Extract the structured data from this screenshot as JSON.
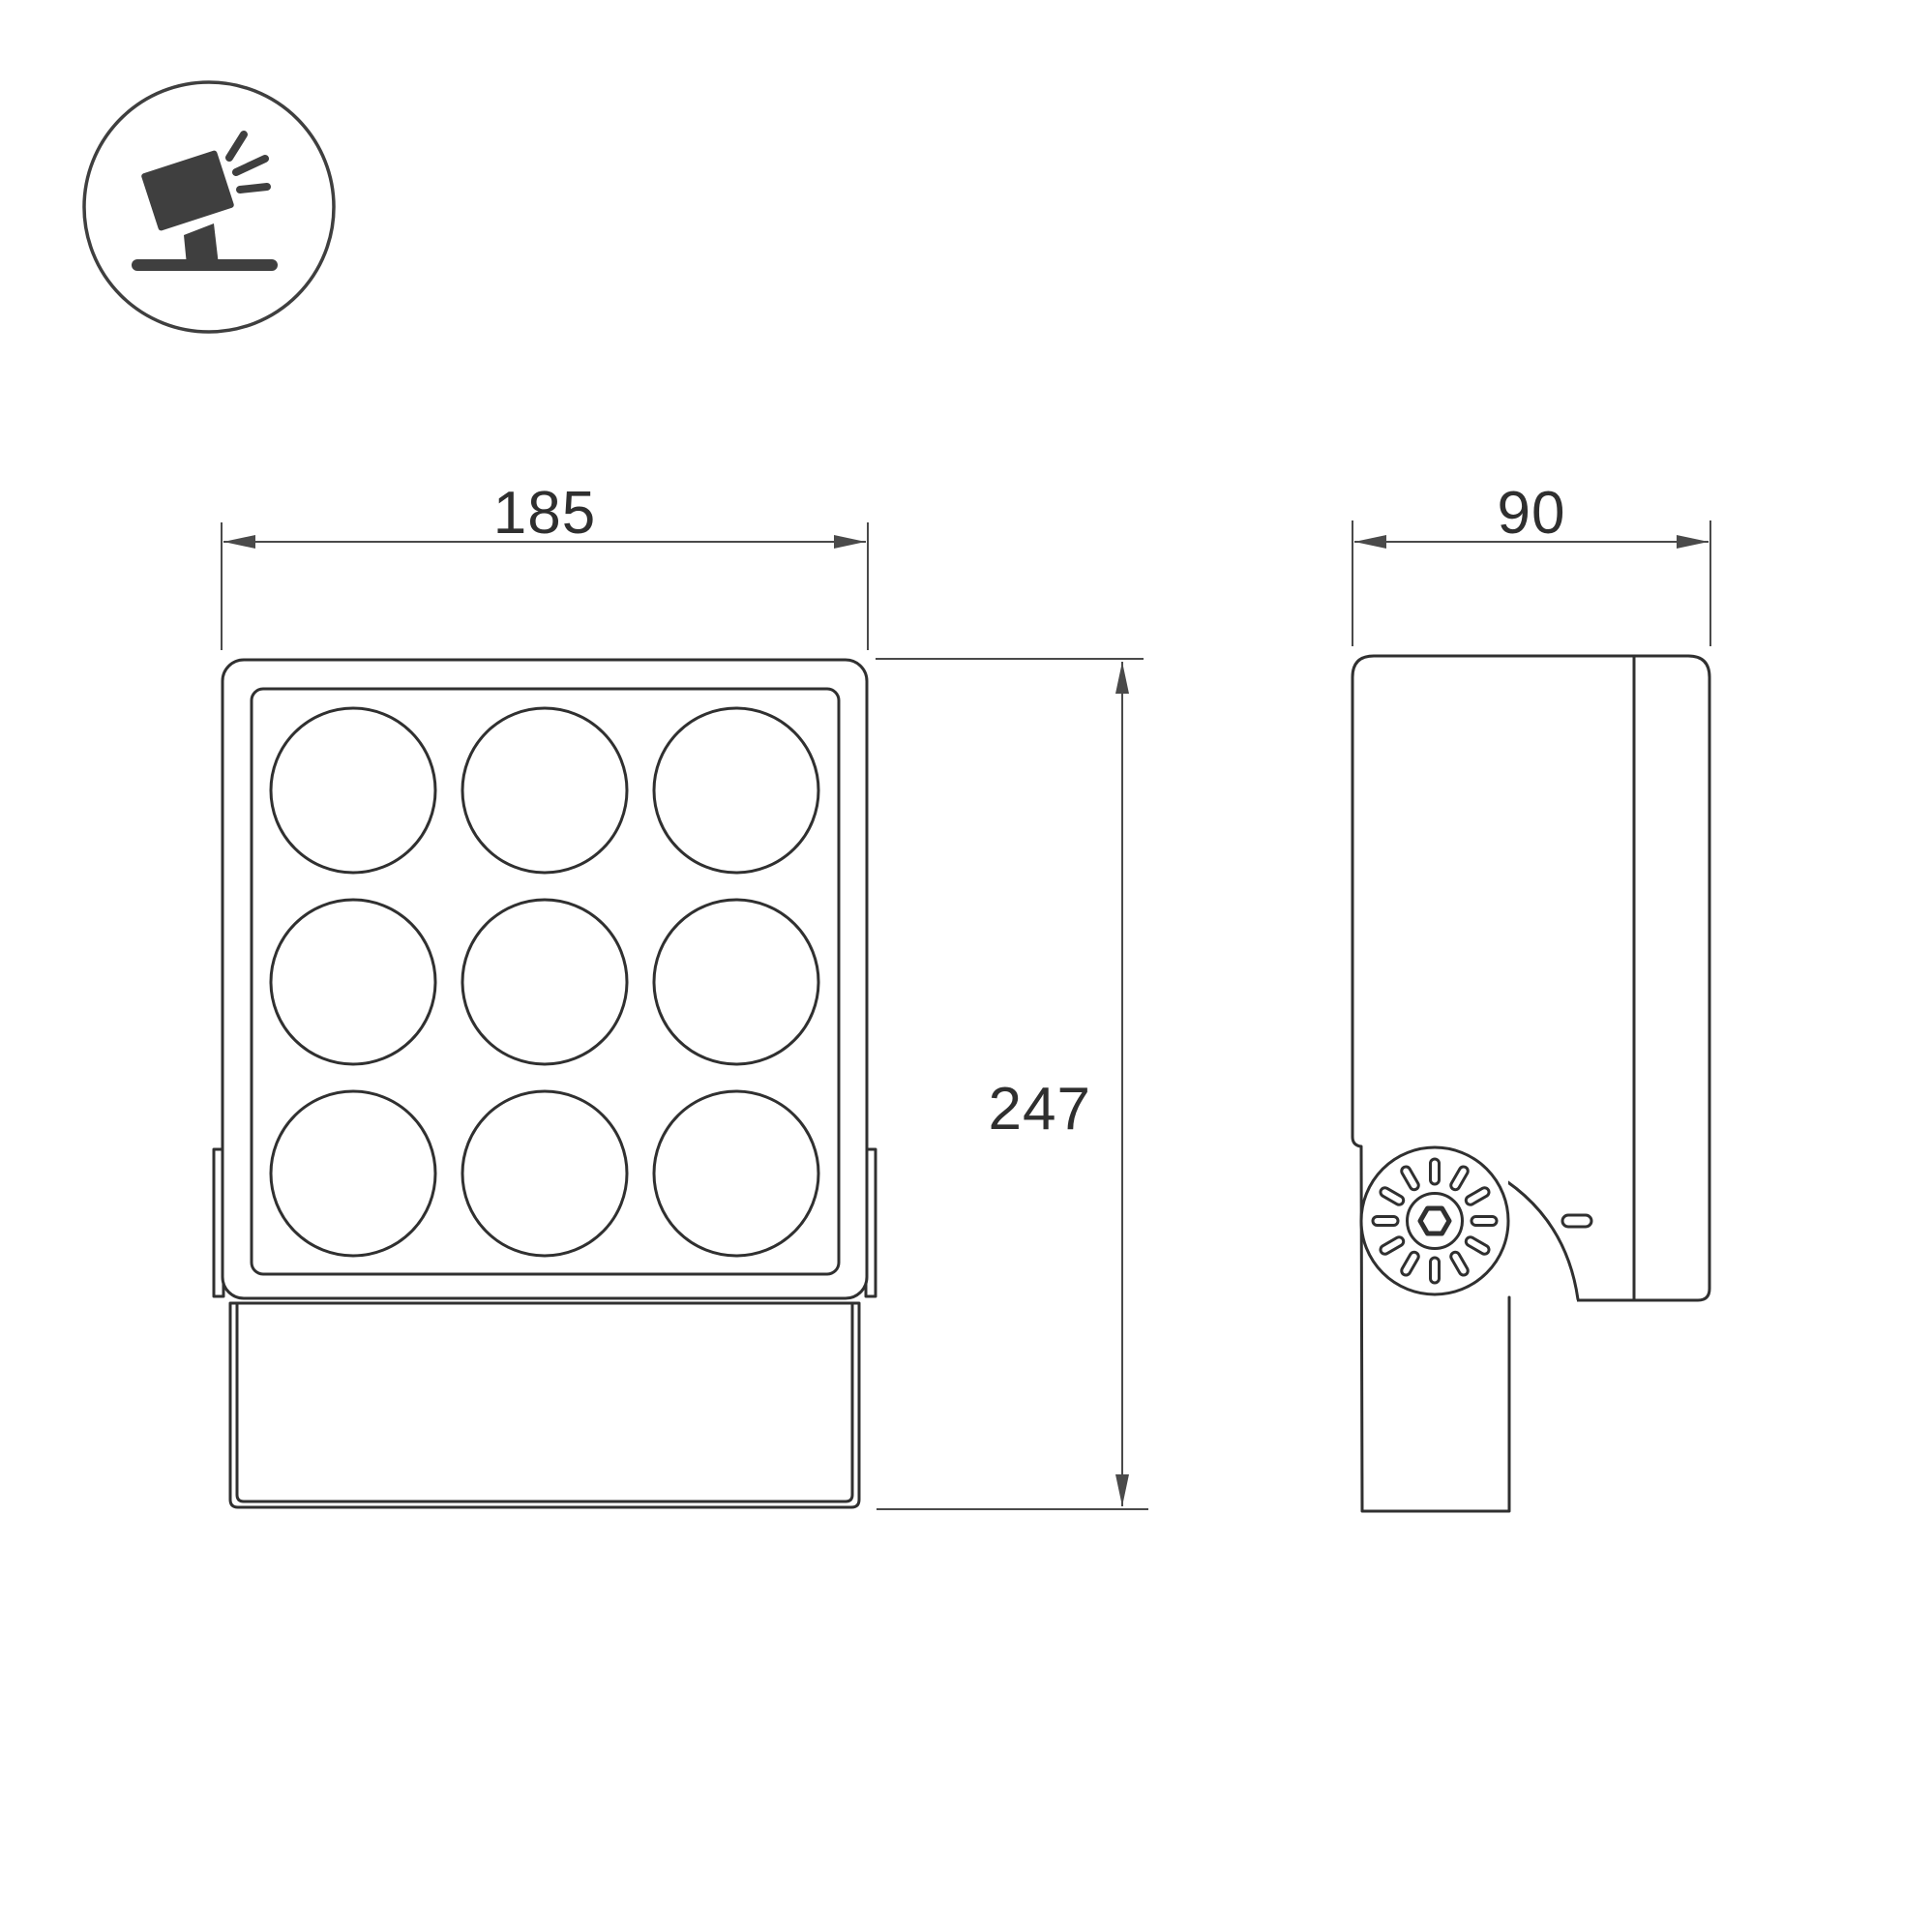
{
  "dimensions": {
    "front_width": "185",
    "height": "247",
    "depth": "90"
  },
  "colors": {
    "background": "#ffffff",
    "line": "#303030",
    "dimension": "#4a4a4a",
    "text": "#2f2f2f",
    "icon": "#3f3f3f"
  },
  "icons": {
    "product_pictogram": "floodlight-on-stand-icon"
  }
}
